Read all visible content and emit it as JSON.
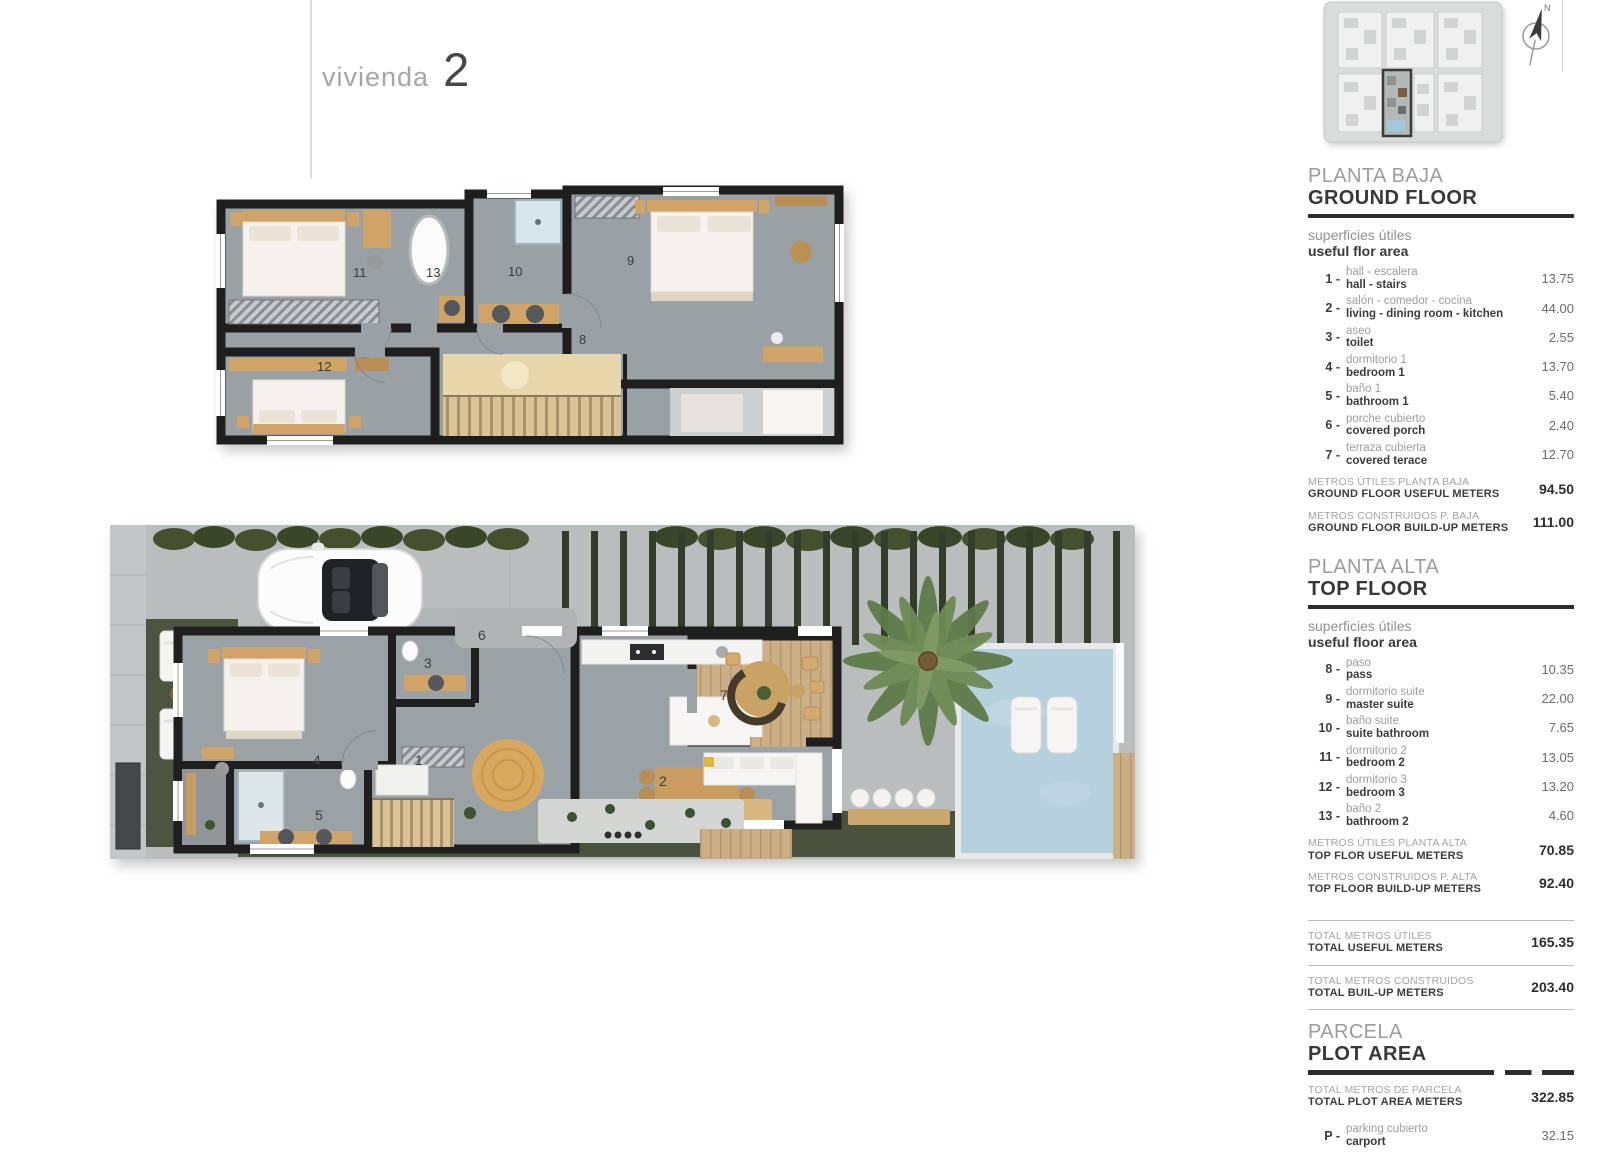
{
  "page": {
    "title_label": "vivienda",
    "title_number": "2"
  },
  "key_plan": {
    "north_label": "N"
  },
  "plans": {
    "top_floor": {
      "labels": {
        "r8": "8",
        "r9": "9",
        "r10": "10",
        "r11": "11",
        "r12": "12",
        "r13": "13"
      }
    },
    "ground_floor": {
      "labels": {
        "r1": "1",
        "r2": "2",
        "r3": "3",
        "r4": "4",
        "r5": "5",
        "r6": "6",
        "r7": "7"
      }
    }
  },
  "sidebar": {
    "ground": {
      "heading_es": "PLANTA BAJA",
      "heading_en": "GROUND FLOOR",
      "sub_es": "superficies útiles",
      "sub_en": "useful flor area",
      "rows": [
        {
          "num": "1 -",
          "es": "hall - escalera",
          "en": "hall - stairs",
          "value": "13.75"
        },
        {
          "num": "2 -",
          "es": "salón - comedor - cocina",
          "en": "living - dining room - kitchen",
          "value": "44.00"
        },
        {
          "num": "3 -",
          "es": "aseo",
          "en": "toilet",
          "value": "2.55"
        },
        {
          "num": "4 -",
          "es": "dormitorio 1",
          "en": "bedroom 1",
          "value": "13.70"
        },
        {
          "num": "5 -",
          "es": "baño 1",
          "en": "bathroom 1",
          "value": "5.40"
        },
        {
          "num": "6 -",
          "es": "porche cubierto",
          "en": "covered porch",
          "value": "2.40"
        },
        {
          "num": "7 -",
          "es": "terraza cubierta",
          "en": "covered terace",
          "value": "12.70"
        }
      ],
      "totals": [
        {
          "es": "METROS ÚTILES PLANTA BAJA",
          "en": "GROUND FLOOR USEFUL METERS",
          "value": "94.50"
        },
        {
          "es": "METROS CONSTRUIDOS P. BAJA",
          "en": "GROUND FLOOR BUILD-UP METERS",
          "value": "111.00"
        }
      ]
    },
    "top": {
      "heading_es": "PLANTA ALTA",
      "heading_en": "TOP FLOOR",
      "sub_es": "superficies útiles",
      "sub_en": "useful floor area",
      "rows": [
        {
          "num": "8 -",
          "es": "paso",
          "en": "pass",
          "value": "10.35"
        },
        {
          "num": "9 -",
          "es": "dormitorio suite",
          "en": "master suite",
          "value": "22.00"
        },
        {
          "num": "10 -",
          "es": "baño suite",
          "en": "suite bathroom",
          "value": "7.65"
        },
        {
          "num": "11 -",
          "es": "dormitorio 2",
          "en": "bedroom 2",
          "value": "13.05"
        },
        {
          "num": "12 -",
          "es": "dormitorio 3",
          "en": "bedroom 3",
          "value": "13.20"
        },
        {
          "num": "13 -",
          "es": "baño 2",
          "en": "bathroom 2",
          "value": "4.60"
        }
      ],
      "totals": [
        {
          "es": "METROS ÚTILES PLANTA ALTA",
          "en": "TOP FLOR USEFUL METERS",
          "value": "70.85"
        },
        {
          "es": "METROS CONSTRUIDOS P. ALTA",
          "en": "TOP FLOOR BUILD-UP METERS",
          "value": "92.40"
        }
      ]
    },
    "grand_totals": [
      {
        "es": "TOTAL METROS ÚTILES",
        "en": "TOTAL USEFUL METERS",
        "value": "165.35"
      },
      {
        "es": "TOTAL METROS CONSTRUIDOS",
        "en": "TOTAL BUIL-UP METERS",
        "value": "203.40"
      }
    ],
    "parcel": {
      "heading_es": "PARCELA",
      "heading_en": "PLOT AREA",
      "total": {
        "es": "TOTAL METROS DE PARCELA",
        "en": "TOTAL PLOT AREA METERS",
        "value": "322.85"
      },
      "row": {
        "num": "P -",
        "es": "parking cubierto",
        "en": "carport",
        "value": "32.15"
      }
    }
  }
}
